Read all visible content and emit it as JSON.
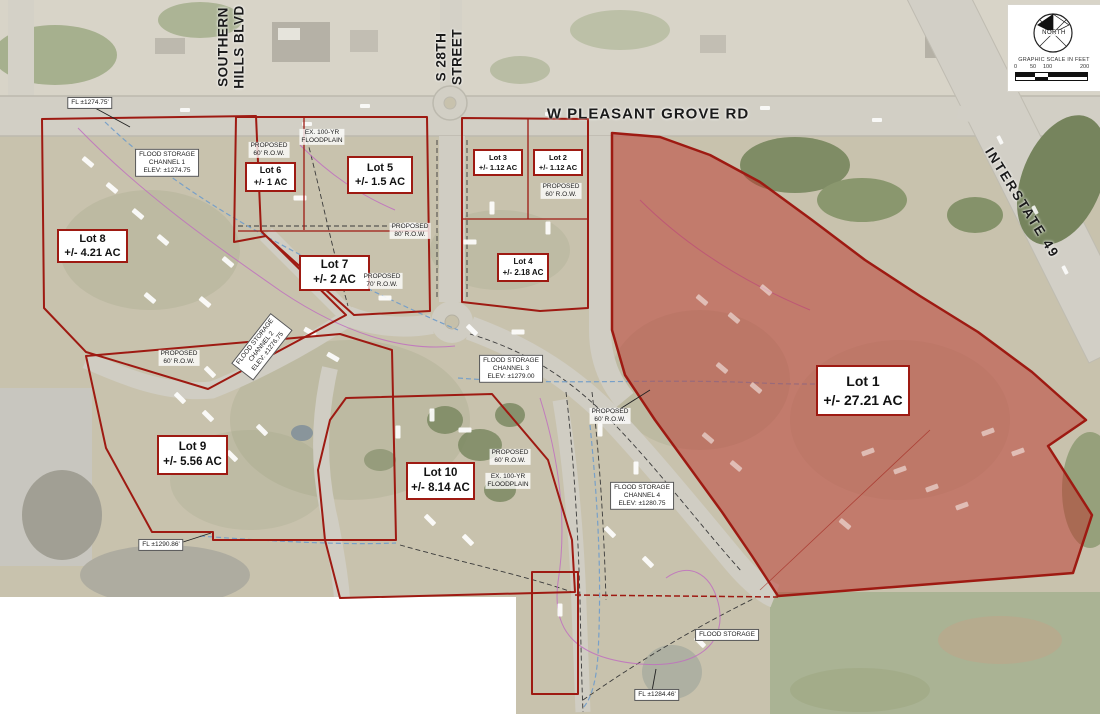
{
  "streets": {
    "southern_hills": {
      "line1": "SOUTHERN",
      "line2": "HILLS BLVD"
    },
    "s_28th": {
      "line1": "S 28TH",
      "line2": "STREET"
    },
    "pleasant_grove": "W PLEASANT GROVE RD",
    "interstate": "INTERSTATE 49"
  },
  "lots": [
    {
      "name": "Lot 1",
      "acreage": "+/- 27.21 AC"
    },
    {
      "name": "Lot 2",
      "acreage": "+/- 1.12 AC"
    },
    {
      "name": "Lot 3",
      "acreage": "+/- 1.12 AC"
    },
    {
      "name": "Lot 4",
      "acreage": "+/- 2.18 AC"
    },
    {
      "name": "Lot 5",
      "acreage": "+/- 1.5 AC"
    },
    {
      "name": "Lot 6",
      "acreage": "+/- 1 AC"
    },
    {
      "name": "Lot 7",
      "acreage": "+/- 2 AC"
    },
    {
      "name": "Lot 8",
      "acreage": "+/- 4.21 AC"
    },
    {
      "name": "Lot 9",
      "acreage": "+/- 5.56 AC"
    },
    {
      "name": "Lot 10",
      "acreage": "+/- 8.14 AC"
    }
  ],
  "notes": [
    [
      "FL ±1274.75'"
    ],
    [
      "FLOOD STORAGE",
      "CHANNEL 1",
      "ELEV: ±1274.75"
    ],
    [
      "PROPOSED",
      "60' R.O.W."
    ],
    [
      "EX. 100-YR",
      "FLOODPLAIN"
    ],
    [
      "PROPOSED",
      "80' R.O.W."
    ],
    [
      "PROPOSED",
      "70' R.O.W."
    ],
    [
      "PROPOSED",
      "60' R.O.W."
    ],
    [
      "FLOOD STORAGE",
      "CHANNEL 2",
      "ELEV: ±1276.75"
    ],
    [
      "FLOOD STORAGE",
      "CHANNEL 3",
      "ELEV: ±1279.00"
    ],
    [
      "PROPOSED",
      "60' R.O.W."
    ],
    [
      "PROPOSED",
      "60' R.O.W."
    ],
    [
      "PROPOSED",
      "60' R.O.W."
    ],
    [
      "EX. 100-YR",
      "FLOODPLAIN"
    ],
    [
      "FLOOD STORAGE",
      "CHANNEL 4",
      "ELEV: ±1280.75"
    ],
    [
      "FLOOD STORAGE"
    ],
    [
      "FL ±1284.46'"
    ],
    [
      "FL ±1290.86'"
    ]
  ],
  "legend": {
    "north": "NORTH",
    "scale_title": "GRAPHIC SCALE IN FEET",
    "ticks": [
      "0",
      "50",
      "100",
      "200"
    ]
  },
  "colors": {
    "lot_fill": "#bb342b",
    "lot_outline": "#9e1a12",
    "floodline_blue": "#78a0c8",
    "floodline_magenta": "#c06ec0"
  }
}
